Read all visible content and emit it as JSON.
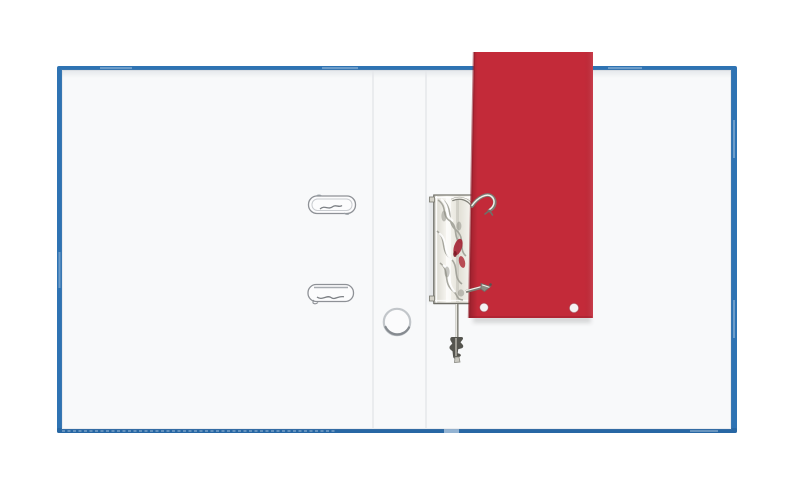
{
  "scene": {
    "subject": "open-lever-arch-binder-top-view",
    "objects": {
      "binder": "blue lever-arch binder lying open, viewed from above",
      "inner_lining": "white inner lining pages",
      "mechanism": "silver chrome lever-arch mechanism on the spine",
      "divider": "red card divider filed on the rings, protruding past the top edge",
      "clamps": "two flat metal paper-clamp rails on the left page",
      "eyelet": "round metal eyelet ring lying near the spine",
      "lever": "metal opening lever below the mechanism"
    }
  },
  "colors": {
    "background": "#ffffff",
    "binder_blue": "#2e73b3",
    "binder_blue_deep": "#225d97",
    "page_white": "#f8f9fa",
    "spine_crease": "#e6e8eb",
    "card_red": "#c32a39",
    "card_red_deep": "#8f1d2a",
    "metal_light": "#f7f6f1",
    "metal_mid": "#d4d2c9",
    "metal_dark": "#80807a",
    "hole_white": "#f5f1f2"
  }
}
